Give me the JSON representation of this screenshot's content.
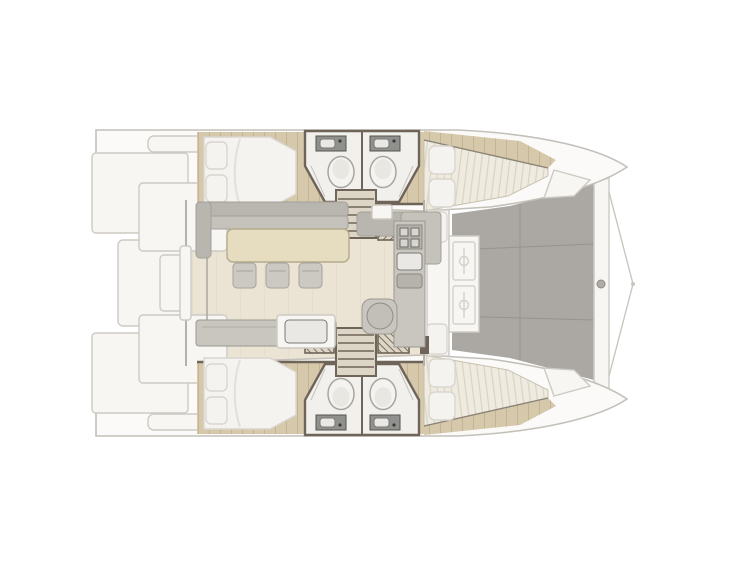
{
  "meta": {
    "type": "catamaran-deck-layout-plan",
    "orientation": "bow-right-stern-left"
  },
  "colors": {
    "background": "#ffffff",
    "hull_fill": "#fbfaf8",
    "hull_stroke": "#c3c0ba",
    "panel_stroke": "#cdcac4",
    "white_panel": "#f7f6f3",
    "wood": "#d5c8ab",
    "wood_line": "#c3b494",
    "saloon_floor": "#ebe4d4",
    "saloon_line": "#ddd4c0",
    "wall_dark": "#6e6459",
    "bath_floor": "#f1f0ec",
    "counter_dark": "#90918f",
    "toilet": "#f4f3f0",
    "step_fill": "#ddd6c6",
    "berth_bg": "#efebe0",
    "berth_stripe": "#d9d3c2",
    "cushion": "#f5f3ef",
    "cushion_stroke": "#d9d6d0",
    "deck_gray": "#aba7a3",
    "deck_line": "#97938f",
    "fixture_gray": "#c9c6c0",
    "fixture_stroke": "#9b9891",
    "sofa_gray": "#b9b6b0",
    "table_beige": "#e6dcc0",
    "table_stroke": "#b4aa8c"
  },
  "plan": {
    "hulls": 2,
    "cabins": [
      {
        "id": "aft-cabin-upper",
        "features": [
          "double-bed",
          "two-pillows",
          "wood-floor"
        ]
      },
      {
        "id": "aft-cabin-lower",
        "features": [
          "double-bed",
          "two-pillows",
          "wood-floor"
        ]
      },
      {
        "id": "forward-cabin-upper",
        "features": [
          "tapered-berth",
          "two-pillows"
        ]
      },
      {
        "id": "forward-cabin-lower",
        "features": [
          "tapered-berth",
          "two-pillows"
        ]
      }
    ],
    "heads": [
      {
        "id": "head-upper-aft",
        "fixtures": [
          "sink",
          "toilet",
          "shower"
        ]
      },
      {
        "id": "head-upper-forward",
        "fixtures": [
          "sink",
          "toilet",
          "shower"
        ]
      },
      {
        "id": "head-lower-aft",
        "fixtures": [
          "sink",
          "toilet",
          "shower"
        ]
      },
      {
        "id": "head-lower-forward",
        "fixtures": [
          "sink",
          "toilet",
          "shower"
        ]
      }
    ],
    "saloon": {
      "features": [
        "l-shaped-sofa",
        "dining-table",
        "three-stools",
        "chaise",
        "galley-counter",
        "sink",
        "stove",
        "round-pod"
      ]
    },
    "stairs": [
      "companionway-upper",
      "companionway-lower"
    ],
    "exterior": {
      "aft": [
        "swim-platforms",
        "transom-steps",
        "davit"
      ],
      "forward": [
        "cockpit-bench",
        "two-deck-hatches",
        "solid-foredeck",
        "cross-beam",
        "bow-bridle"
      ]
    }
  }
}
